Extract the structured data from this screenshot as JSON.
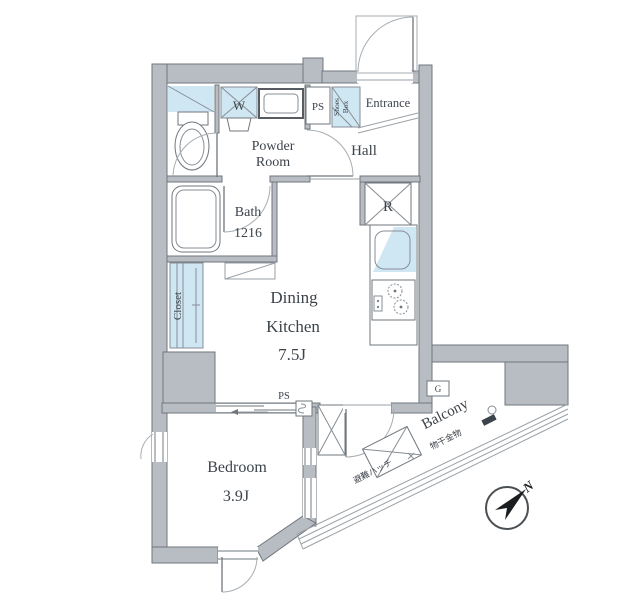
{
  "plan": {
    "rooms": {
      "entrance": "Entrance",
      "hall": "Hall",
      "powder_room_line1": "Powder",
      "powder_room_line2": "Room",
      "bath": "Bath",
      "bath_size": "1216",
      "dining_line1": "Dining",
      "dining_line2": "Kitchen",
      "dining_size": "7.5J",
      "bedroom": "Bedroom",
      "bedroom_size": "3.9J",
      "closet": "Closet",
      "balcony": "Balcony"
    },
    "fixtures": {
      "washing_machine": "W",
      "refrigerator": "R",
      "gas_meter": "G",
      "pipe_space_top": "PS",
      "pipe_space_bottom": "PS",
      "shoes_box_line1": "Shoes",
      "shoes_box_line2": "Box",
      "evacuation_hatch": "避難ハッチ",
      "laundry_hardware": "物干金物"
    },
    "compass": {
      "north": "N"
    },
    "colors": {
      "wall_fill": "#b7bdc3",
      "wall_outline": "#70777e",
      "fixture_blue": "#cfe7f3",
      "text": "#3c434a",
      "thin_line": "#9aa1a7"
    }
  }
}
